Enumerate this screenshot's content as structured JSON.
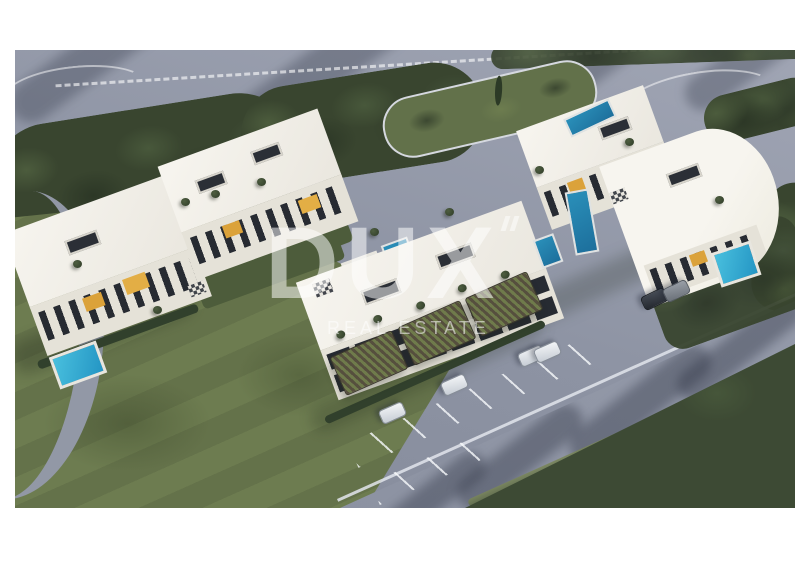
{
  "page": {
    "background": "#ffffff"
  },
  "photo": {
    "description": "Aerial 3D rendering of a modern white residential apartment complex with rooftop terraces, swimming pools, yellow facade accents, pergola carports, parked cars, landscaped gardens, surrounding gray roads, a green lawn and dense forest",
    "watermark": {
      "title": "DUX",
      "subtitle": "REAL ESTATE"
    },
    "colors": {
      "border": "#ffffff",
      "road": "#939aa9",
      "shadow": "#2c3242",
      "trees": "#39452f",
      "lawn": "#6d7c50",
      "forest": "#3d4a34",
      "building_white": "#f2f0ea",
      "facade": "#e5e2d8",
      "window_dark": "#262a31",
      "accent_yellow": "#dba23a",
      "pool_cyan": "#38b0d2",
      "pool_deep": "#1f7fae",
      "car_white": "#e9ebee",
      "watermark_white": "#ffffff"
    }
  }
}
